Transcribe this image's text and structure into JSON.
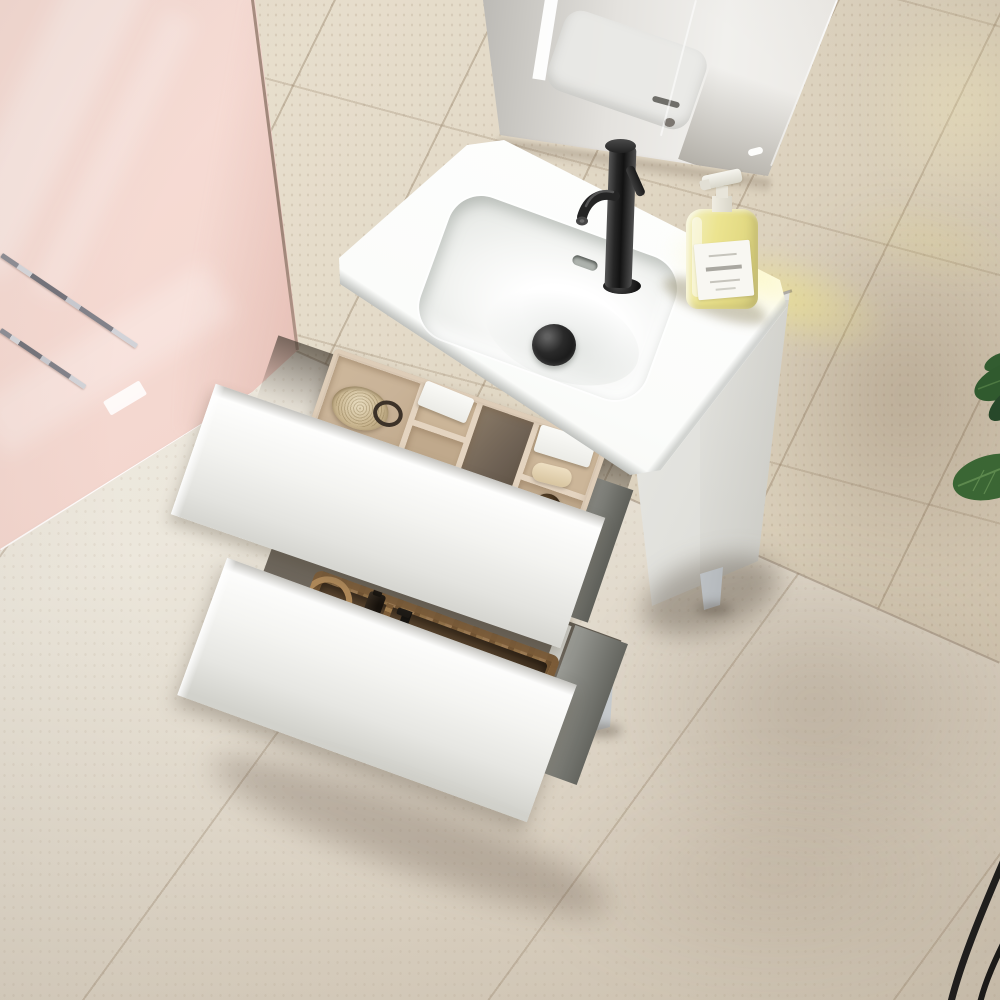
{
  "scene": {
    "type": "bathroom-product-photo",
    "view": "top-down angled view of a freestanding white bathroom vanity with two open drawers",
    "objects": [
      "pink-accent-wall",
      "pink-walk-in-shower-floor",
      "linear-shower-drain-strips",
      "beige-stone-wall-tiles",
      "beige-stone-floor-tiles",
      "wall-mirror-with-reflections",
      "white-vanity-cabinet",
      "integrated-white-ceramic-basin",
      "black-matte-monobloc-faucet",
      "black-pop-up-drain",
      "overflow-slot",
      "yellow-soap-dispenser-bottle-with-white-label",
      "open-top-drawer",
      "beige-drawer-organizer-tray",
      "natural-fiber-brush",
      "leather-strap-loop",
      "white-boxes",
      "soap-bar",
      "dark-amber-glass-bottles",
      "open-bottom-drawer",
      "wicker-storage-basket-with-rope-handle",
      "amber-jar",
      "amber-pump-bottle",
      "black-pump-bottle",
      "gray-pump-bottle",
      "rolled-gray-towels",
      "chrome-square-legs",
      "green-plant-leaves",
      "black-stool-legs"
    ]
  },
  "palette": {
    "pink_wall": "#f4d7cf",
    "pink_floor": "#f6dfd9",
    "wall_edge_dark": "#8d7668",
    "wall_beige": "#e3dac8",
    "wall_beige_dark": "#cfc2ad",
    "floor_beige": "#ece7dc",
    "floor_beige_dark": "#d8cebe",
    "mirror_pink": "#eed6d0",
    "mirror_gray": "#a8a6a2",
    "mirror_light": "#f1f0ed",
    "ceramic_white": "#fbfcfa",
    "ceramic_shade": "#dfe2df",
    "basin_gray": "#e7e9e6",
    "faucet_black": "#262626",
    "drain_black": "#111111",
    "soap_yellow": "#ece490",
    "soap_label": "#f8f7f2",
    "cabinet_white": "#f4f4f1",
    "cabinet_shade": "#d8d8d2",
    "drawer_wall_gray": "#84857f",
    "drawer_cavity": "#5f594f",
    "organizer_base": "#c9b398",
    "organizer_wall": "#e4d4c0",
    "organizer_dark": "#6e6154",
    "wicker": "#a9855b",
    "wicker_dark": "#7c5c38",
    "basket_interior": "#55412b",
    "towel_gray": "#8f9995",
    "bottle_amber": "#2e2012",
    "bottle_gray": "#b0a69b",
    "leg_chrome": "#b9bfc3",
    "leaf_green": "#35602f",
    "leaf_green_dark": "#27492a",
    "sun_yellow": "#f3e87e",
    "shadow_warm": "#7d6a56"
  }
}
